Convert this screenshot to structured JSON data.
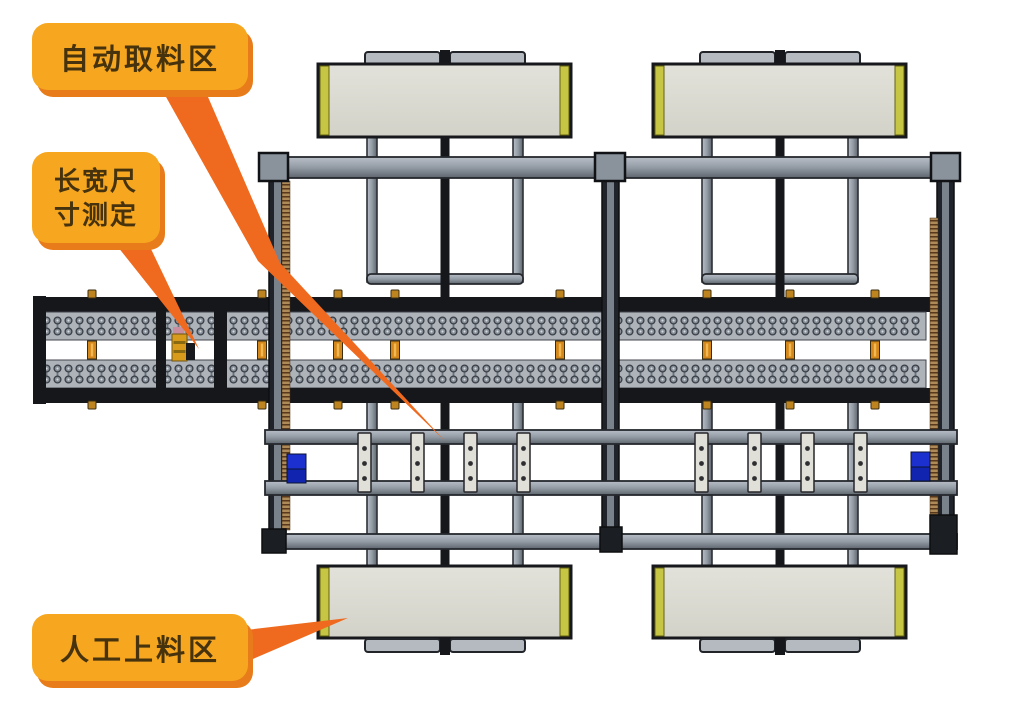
{
  "page": {
    "background": "#ffffff"
  },
  "colors": {
    "page_bg": "#ffffff",
    "callout_fill": "#f7a71f",
    "callout_shadow": "#e97c1a",
    "callout_text": "#46330e",
    "leader": "#ef6a1e",
    "platform_edge_cap": "#c6c544",
    "conveyor_black": "#15171b",
    "connector_orange": "#d4881c",
    "sensor_blue": "#1c30cf"
  },
  "callouts": [
    {
      "label": "自动取料区",
      "target": "automatic-pickup-area"
    },
    {
      "label": "长宽尺寸测定",
      "lines": [
        "长宽尺",
        "寸测定"
      ],
      "target": "length-width-measurement-station"
    },
    {
      "label": "人工上料区",
      "target": "manual-loading-area"
    }
  ]
}
